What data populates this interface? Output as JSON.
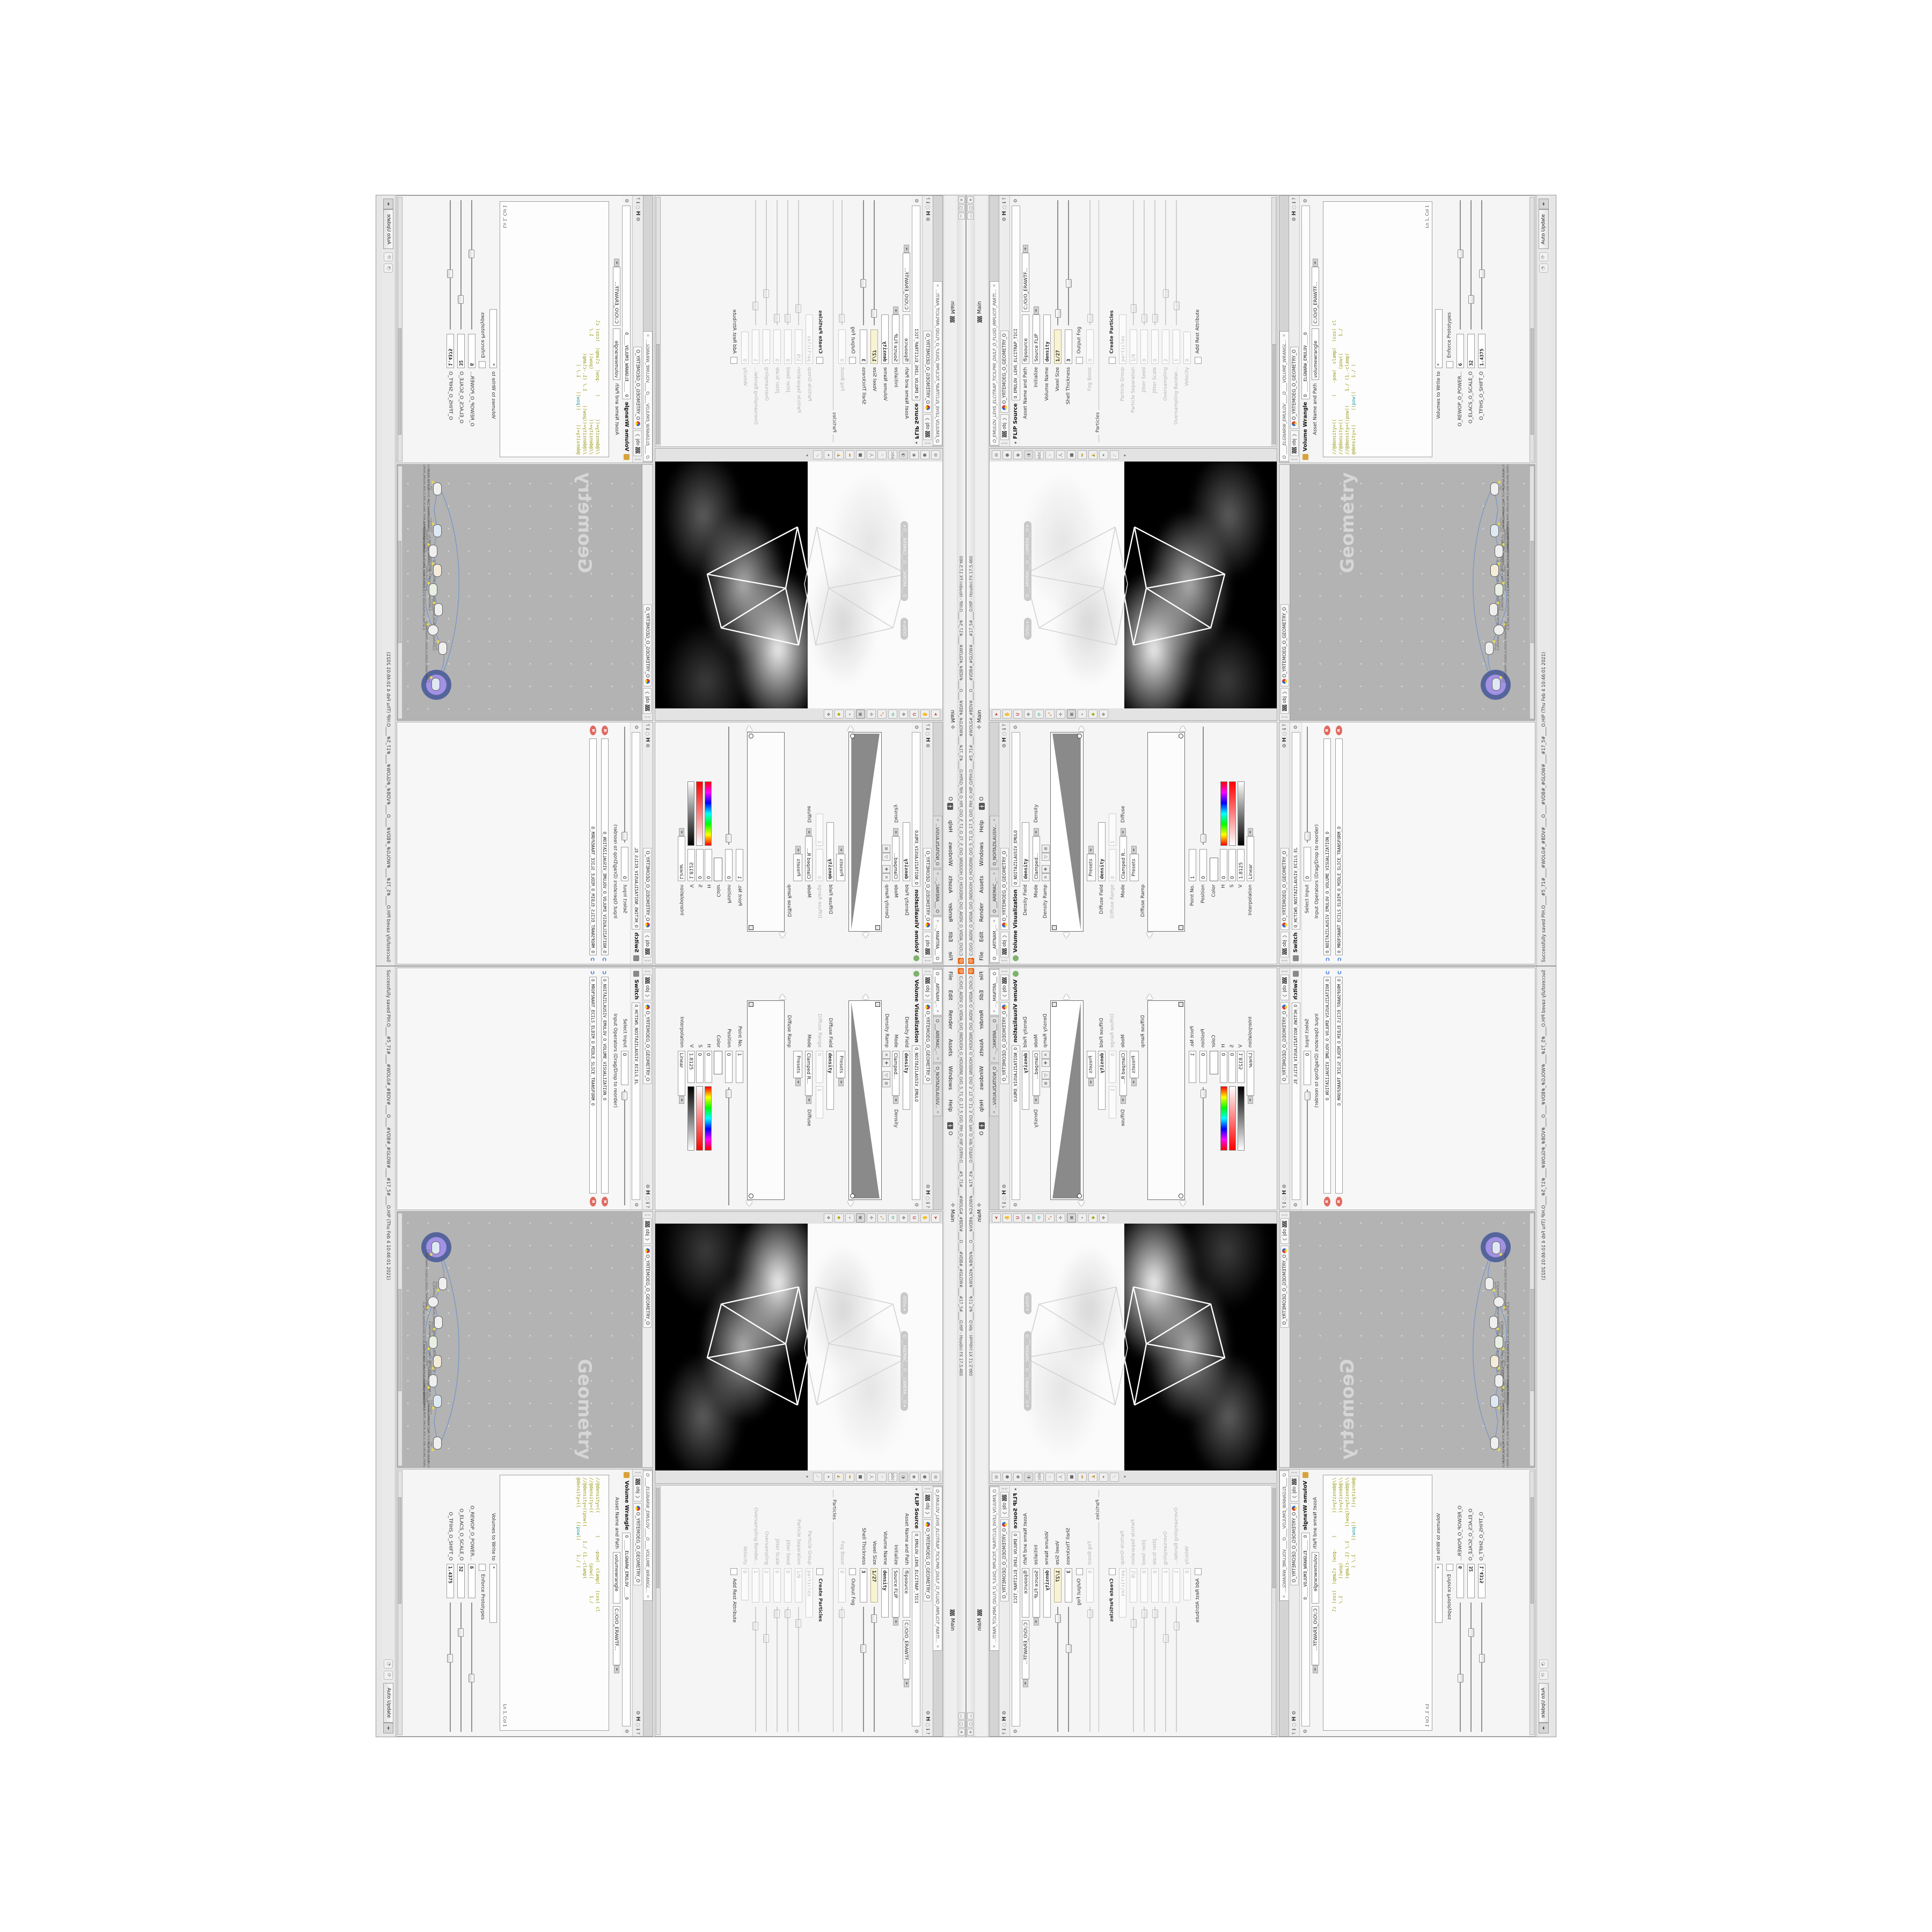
{
  "app": {
    "title": "C:/O/O_AIDIV_O_VIDIA_O/O_INIDUOH_O_HOUDINI_O/O_5_71_O_17_5_O/O_PIH_O_HIP_O/PIH.O____#5_71#____#WOLG#_#BDV#____O____#VDB#_#GLOW#____#17_5#____O.HIP - Houdini FX 17.5.460",
    "menus": [
      "File",
      "Edit",
      "Render",
      "Assets",
      "Windows",
      "Help"
    ],
    "menu_o": "O",
    "main_label": "Main",
    "main_label2": "Main",
    "win_min": "—",
    "win_max": "▢",
    "win_close": "✕"
  },
  "paths": {
    "context": "obj",
    "geo": "O_YRTEMOEG_O_GEOMETRY_O",
    "houdini_h": "H"
  },
  "vis_pane": {
    "tabs": [
      "O ___ARTNAM_...",
      "O ___AREMAC_...",
      "O_NOITAZILAUSIV..."
    ],
    "type": "Volume Visualization",
    "name": "O_NOITAZILAUSIV_EMULO",
    "density_field_label": "Density Field",
    "density_field": "density",
    "mode_label": "Mode",
    "mode_value": "Clamped...",
    "mode_suffix": "Density",
    "density_ramp_label": "Density Ramp",
    "presets_label": "Presets",
    "diffuse_field_label": "Diffuse Field",
    "diffuse_field": "density",
    "diffuse_range_label": "Diffuse Range",
    "diffuse_range_min": "0",
    "diffuse_range_max": "1",
    "mode2_label": "Mode",
    "mode2_value": "Clamped R...",
    "mode2_suffix": "Diffuse",
    "presets2_label": "Presets",
    "diffuse_ramp_label": "Diffuse Ramp",
    "point_no_label": "Point No.",
    "point_no": "1",
    "position_label": "Position",
    "position": "0",
    "color_label": "Color",
    "h_label": "H",
    "h": "0",
    "s_label": "S",
    "s": "0",
    "v_label": "V",
    "v": "1.8125",
    "interp_label": "Interpolation",
    "interp": "Linear"
  },
  "viewport": {
    "pill_ortho": "Ortho ▾",
    "pill_camera": "O ___AREMAC___O___CAMERA___O ▾"
  },
  "flip_pane": {
    "tab": "O_EMULOV_LEHS_ELCITRAP_TICILPMI_DIULF_O_FLUID_IMPLICIT_PARTI...",
    "type": "FLIP Source",
    "name": "O_EMULOV_LEHS_ELCITRAP_TICI",
    "asset_label": "Asset Name and Path",
    "asset_name": "flipsource",
    "asset_path": "C:/O/O_ERAWTF...",
    "initialize_label": "Initialize",
    "initialize": "Source FLIP",
    "volume_name_label": "Volume Name",
    "volume_name": "density",
    "voxel_size_label": "Voxel Size",
    "voxel_size": "1/27",
    "shell_label": "Shell Thickness",
    "shell": "3",
    "output_fog_label": "Output Fog",
    "fog_boost_label": "Fog Boost",
    "fog_boost": "0",
    "particles_group": "Particles",
    "create_particles_label": "Create Particles",
    "particle_group_label": "Particle Group",
    "particle_group": "particles",
    "particle_sep_label": "Particle Separation",
    "particle_sep": "1/9",
    "jitter_seed_label": "Jitter Seed",
    "jitter_seed": "0",
    "jitter_scale_label": "Jitter Scale",
    "jitter_scale": "0",
    "oversampling_label": "Oversampling",
    "oversampling": "2",
    "oversampling_bw_label": "Oversampling Bandwi...",
    "oversampling_bw": "1",
    "velocity_label": "Velocity",
    "velocity": "0",
    "add_rest_label": "Add Rest Attribute"
  },
  "switch_pane": {
    "type": "Switch",
    "name": "O_HCTIWS_NOITAZILAUSIV_ECILS_EL",
    "select_input_label": "Select Input",
    "select_input": "0",
    "list_label": "Input Operators (Drag/Drop to reorder)",
    "items": [
      "O_NOITAZILAUSIV_EMULOV_O_VOLUME_VISUALIZATION_O",
      "O_MROFSNART_ECILS_ELDIM_O_MIDLE_SLICE_TRANSFORM_O"
    ]
  },
  "network": {
    "watermark": "Geometry",
    "nodes": [
      {
        "type": "Transform",
        "name": "O_MROFSNART_TLUSER_O_RESULT_TRANSFORM_O"
      },
      {
        "type": "Merge",
        "name": "O_ECAFRUS_HTIW_EMULOV_EGREM_O_MERGE_VOLUME_WITH_SURFACE_O"
      },
      {
        "type": "Switch",
        "name": "O_HCTIWS_NOITAZILAUSIV_ECILS_ELDIM_O_MIDLE_SLICE_VISUALIZATION_SWITCH_O"
      },
      {
        "type": "Transform",
        "name": "O_MROFSNART_ECILS_ELDIM_O_MIDLE_SLICE_TRANSFORM_O"
      },
      {
        "type": "Volume Visualization",
        "name": "O_NOITAZILAUSIV_EMULOV_O_VOLUME_VISUALIZATION_O"
      },
      {
        "type": "Volume Wrangle",
        "name": "O____ELGNARW_EMULOV____O____VOLUME_WRANGLE____O"
      },
      {
        "type": "VDB from Polygons",
        "name": "O_SNOGYLOP_YRTEMOEG_MORF_EMULOV_BDV_O_VDB_VOLUME_FROM_GEOMETRY_POLYGONS_O"
      },
      {
        "type": "FLIP Source",
        "name": "O_EMULOV_LEHS_ELCITRAP_TICILPMI_DIULF_O_FLUID_IMPLICIT_PARTICLE_SHEL_VOLUME_O"
      },
      {
        "type": "File",
        "name": "O_ELIF_O_FILE_O"
      }
    ]
  },
  "wrangle_pane": {
    "tab": "O ____ELGNARW_EMULOV____O____VOLUME_WRANGL...",
    "type": "Volume Wrangle",
    "name": "O ____ELGNARW_EMULOV____O",
    "asset_label": "Asset Name and Path",
    "asset_name": "volumewrangle",
    "asset_path": "C:/O/O_ERAWTF...",
    "code_line1": "//@density=((        (    -pow(  clamp(  (cos( cl",
    "code_line2": "//@density=((                  (pow((      1./",
    "code_line3": "//@density=((pow((     1./ (1.-clamp(",
    "code_line4_pre": "@density=((     ((",
    "code_line4_teal": "pow",
    "code_line4_post": "((     1./ (",
    "lncol": "Ln 1, Col 1",
    "volumes_label": "Volumes to Write to",
    "volumes": "*",
    "enforce_label": "Enforce Prototypes",
    "power_label": "O_REWOP_O_POWER...",
    "power": "6",
    "scale_label": "O_ELACS_O_SCALE_O",
    "scale": "32",
    "shift_label": "O_TFIHS_O_SHIFT_O",
    "shift": "1.4375"
  },
  "status": {
    "message": "Successfully saved PIH.O____#5_71#____#WOLG#_#BDV#____O____#VDB#_#GLOW#____#17_5#____O.HIP (Thu Feb 4 10:46:01 2021)",
    "auto_update": "Auto Update"
  },
  "colors": {
    "accent_orange": "#e85d04",
    "selected_node_fill": "#a291e4",
    "selected_node_ring": "#55659c",
    "wire_blue": "#7b97c6",
    "code_olive": "#97970f",
    "code_teal": "#1f9aa8",
    "voxel_field_bg": "#f7f3d3"
  }
}
